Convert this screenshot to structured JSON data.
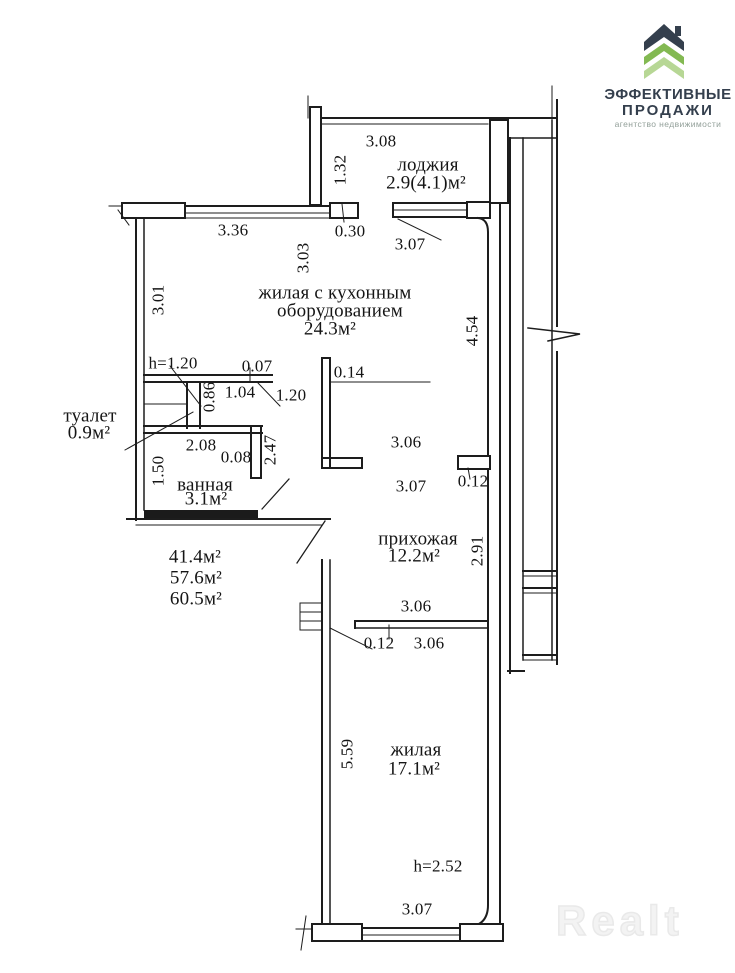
{
  "logo": {
    "line1": "ЭФФЕКТИВНЫЕ",
    "line2": "ПРОДАЖИ",
    "tagline": "агентство недвижимости",
    "colors": {
      "navy": "#343f4d",
      "green_dark": "#83b952",
      "green_light": "#b7d795",
      "tagline_gray": "#93a09a"
    }
  },
  "watermark": "Realt",
  "plan": {
    "line_color": "#1d1d1d",
    "rooms": {
      "loggia": {
        "name": "лоджия",
        "area": "2.9(4.1)м²"
      },
      "living_kitchen": {
        "name_line1": "жилая с кухонным",
        "name_line2": "оборудованием",
        "area": "24.3м²"
      },
      "toilet": {
        "name": "туалет",
        "area": "0.9м²"
      },
      "bathroom": {
        "name": "ванная",
        "area": "3.1м²"
      },
      "hallway": {
        "name": "прихожая",
        "area": "12.2м²"
      },
      "living": {
        "name": "жилая",
        "area": "17.1м²"
      }
    },
    "totals": {
      "line1": "41.4м²",
      "line2": "57.6м²",
      "line3": "60.5м²"
    },
    "heights": {
      "toilet_zone": "h=1.20",
      "living": "h=2.52"
    },
    "dims": {
      "loggia_width": "3.08",
      "loggia_depth": "1.32",
      "window_top": "3.36",
      "balcony_door": "0.30",
      "loggia_bottom": "3.07",
      "wall_303": "3.03",
      "wall_301": "3.01",
      "wall_454": "4.54",
      "d007": "0.07",
      "d104": "1.04",
      "d086": "0.86",
      "d120": "1.20",
      "d014": "0.14",
      "d208": "2.08",
      "d008": "0.08",
      "d247": "2.47",
      "d150": "1.50",
      "hall_306": "3.06",
      "hall_307": "3.07",
      "hall_012": "0.12",
      "hall_291": "2.91",
      "div_306a": "3.06",
      "div_012": "0.12",
      "div_306b": "3.06",
      "living_559": "5.59",
      "living_307": "3.07"
    }
  }
}
